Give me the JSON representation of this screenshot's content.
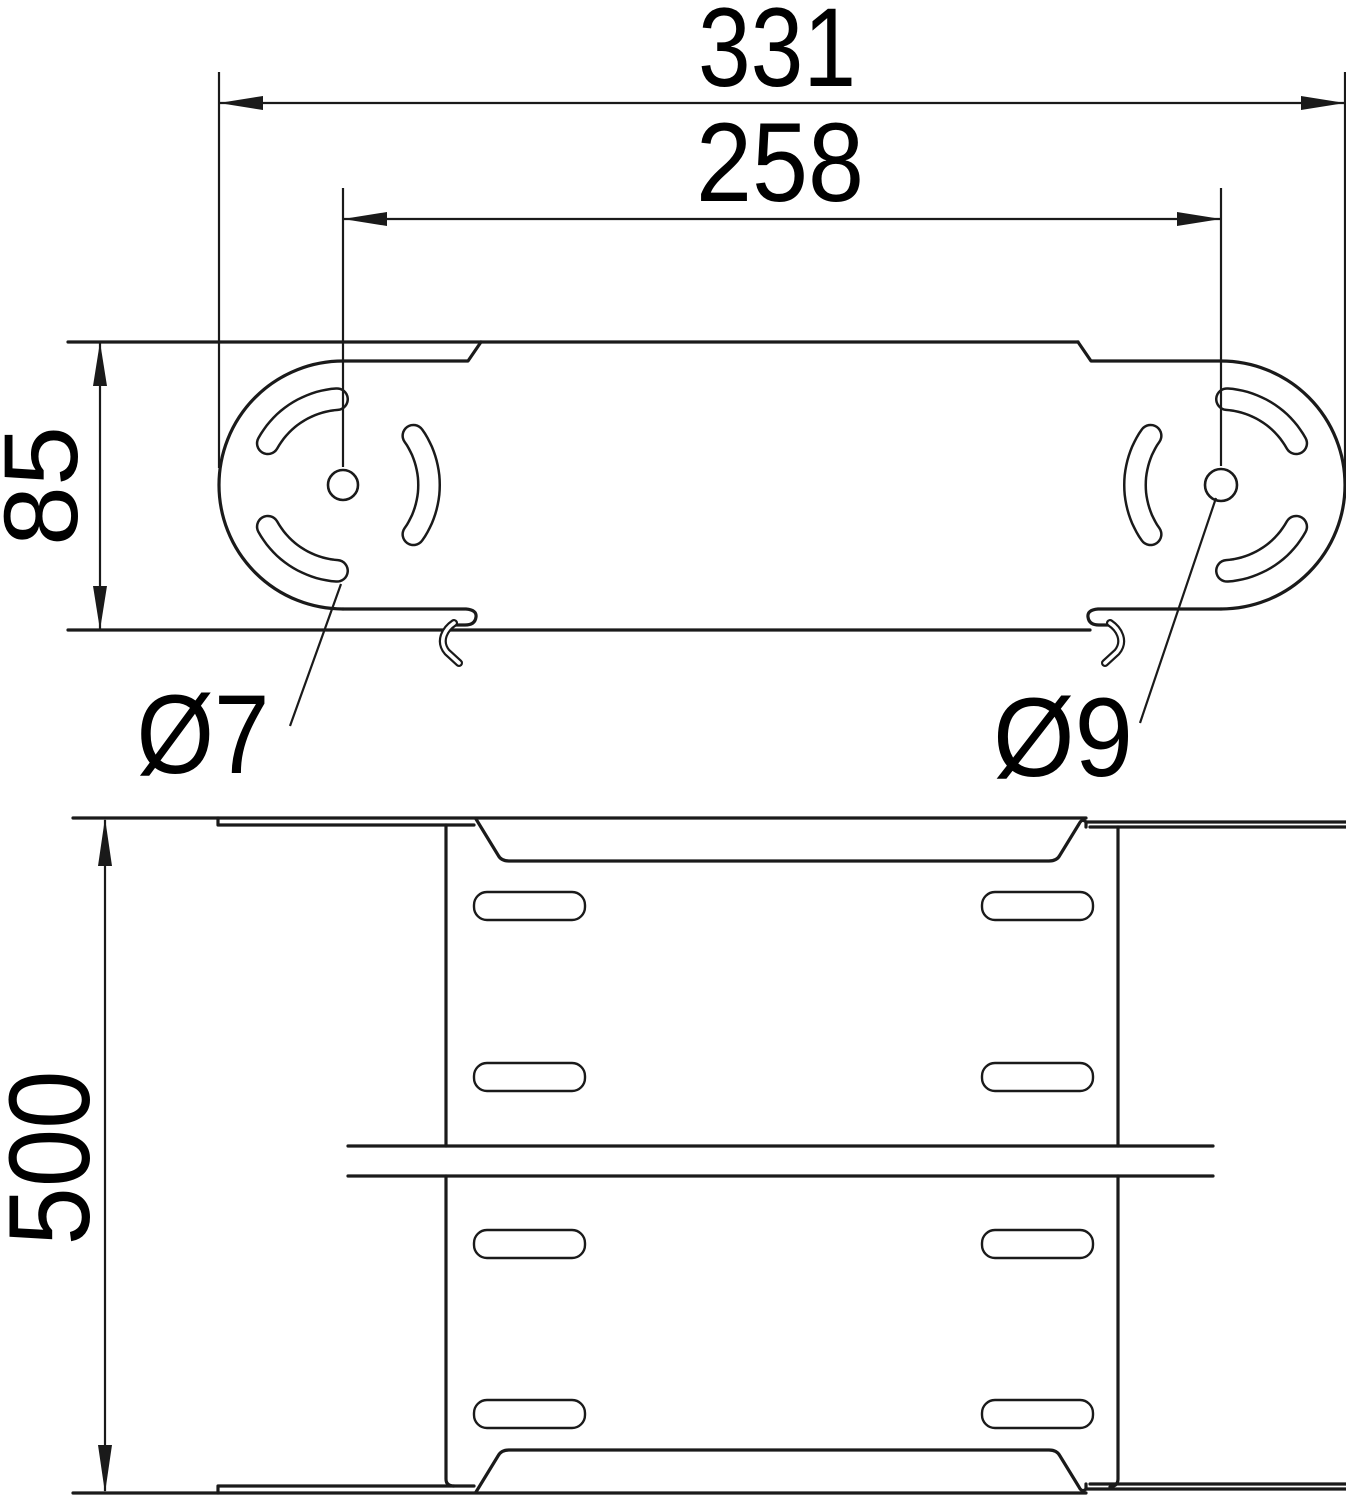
{
  "drawing_type": "technical dimension drawing, two orthographic views of a cable-tray angle connector",
  "colors": {
    "line": "#1a1a1a",
    "background": "#ffffff"
  },
  "labels": {
    "overall_length": "331",
    "hole_spacing": "258",
    "plate_height": "85",
    "slot_width": "Ø7",
    "pivot_hole": "Ø9",
    "tray_width": "500"
  }
}
